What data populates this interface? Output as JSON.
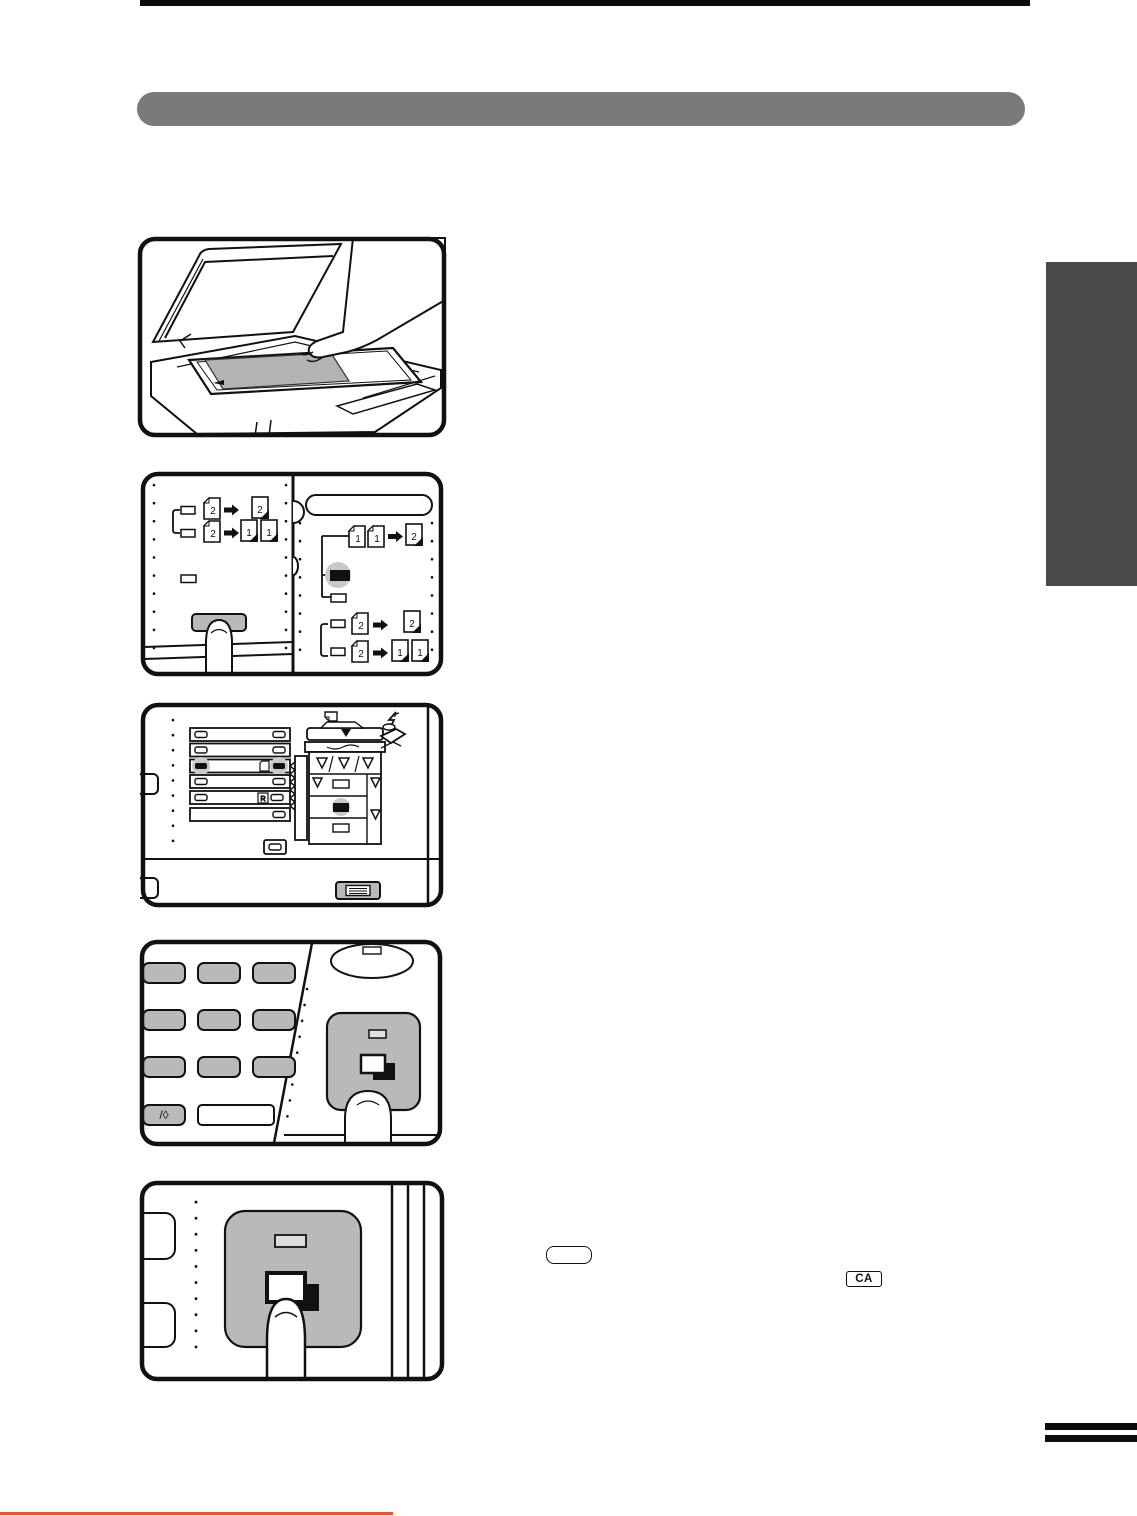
{
  "page": {
    "kind": "copier-manual-instruction-page",
    "colors": {
      "title_bar": "#7a7a7a",
      "side_tab": "#4b494a",
      "top_rule": "#0b0b0b",
      "footer_rule": "#e85430",
      "key_gray": "#b9b9b9",
      "halo_gray": "#c9c9c9",
      "original_gray": "#b3b3b3"
    }
  },
  "inline_keys": {
    "blank_key_label": "",
    "clear_all_key_label": "CA"
  },
  "figures": {
    "step1": "place-original-on-platen",
    "step2": "select-duplex-mode-panel",
    "step3": "paper-tray-selection-panel",
    "step4": "keypad-and-start-key",
    "step5": "press-start-key-closeup"
  },
  "icons": {
    "copy_page_icon": "two-overlapping-pages",
    "misfeed_icon": "lightning-bolt",
    "paper_icon": "sheet-with-folded-corner",
    "tray_key_icon": "stacked-lines",
    "interrupt_key_glyph": "/◊"
  },
  "duplex_icons": {
    "left_row1_from": "2",
    "left_row1_to": "2",
    "left_row2_from": "2",
    "left_row2_to_a": "1",
    "left_row2_to_b": "1",
    "right_row1_from_a": "1",
    "right_row1_from_b": "1",
    "right_row1_to": "2",
    "right_row2_from": "2",
    "right_row2_to": "2",
    "right_row3_from": "2",
    "right_row3_to_a": "1",
    "right_row3_to_b": "1"
  },
  "tray_panel": {
    "r_paper_label": "R"
  }
}
